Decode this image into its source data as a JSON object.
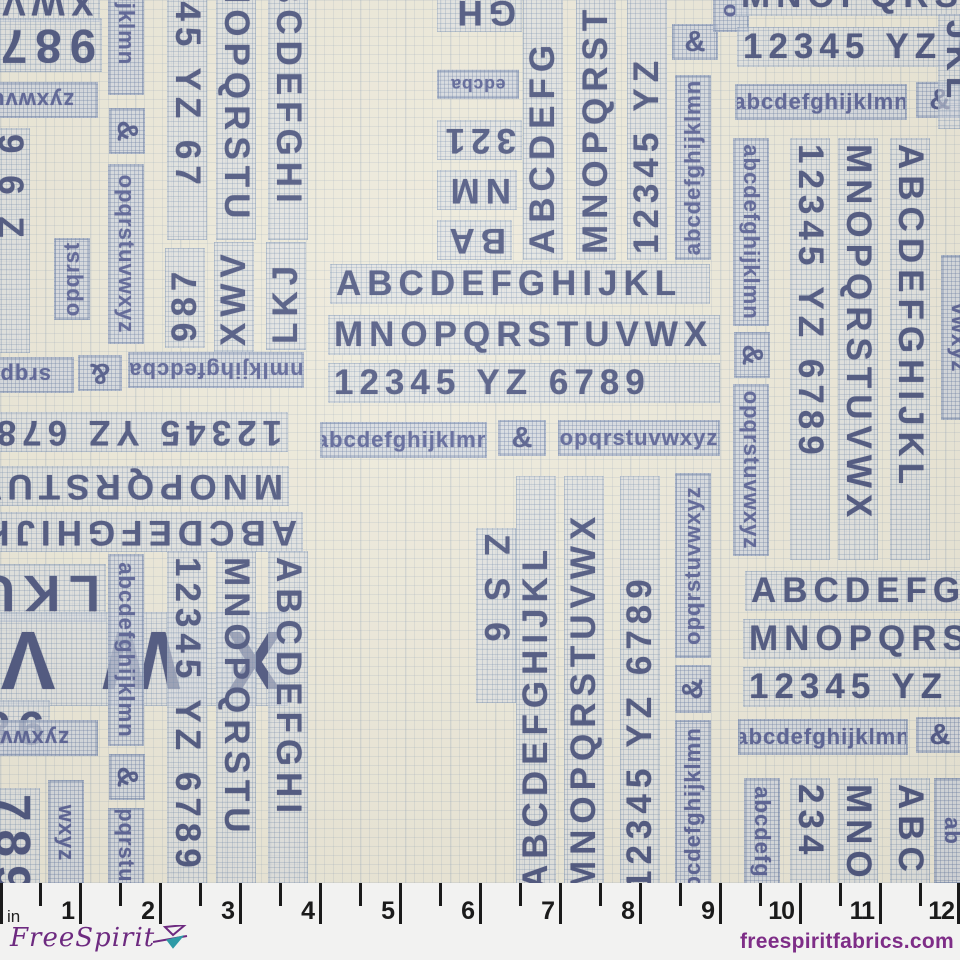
{
  "fabric": {
    "description": "typography letter-chart fabric print",
    "background_color": "#ece9db",
    "grid_color": "#7d94b2",
    "caps_color": "#3b4677",
    "lowercase_color": "#4a5490",
    "alphabet_rows": {
      "row_caps_1": "ABCDEFGHIJKL",
      "row_caps_2": "MNOPQRSTUVWX",
      "row_digits": "12345 YZ 6789",
      "row_lower_1": "abcdefghijklmn",
      "row_amp": "&",
      "row_lower_2": "opqrstuvwxyz"
    },
    "strips": [
      {
        "t": "XWV",
        "k": "caps",
        "x": -20,
        "y": -18,
        "l": 120,
        "r": 180
      },
      {
        "t": "987",
        "k": "caps",
        "x": -48,
        "y": 18,
        "l": 150,
        "r": 180,
        "s": 1.35
      },
      {
        "t": "zyxwvut",
        "k": "box",
        "x": -42,
        "y": 82,
        "l": 140,
        "r": 180
      },
      {
        "t": "9 6 Z",
        "k": "caps",
        "x": -10,
        "y": 128,
        "l": 225,
        "r": 90
      },
      {
        "t": "abcdefghijklmn",
        "k": "box",
        "x": 108,
        "y": -140,
        "l": 235,
        "r": 90
      },
      {
        "t": "&",
        "k": "amp",
        "x": 109,
        "y": 108,
        "l": 46,
        "r": 90
      },
      {
        "t": "opqrstuvwxyz",
        "k": "box",
        "x": 108,
        "y": 164,
        "l": 180,
        "r": 90
      },
      {
        "t": "345 YZ 67",
        "k": "caps",
        "x": 167,
        "y": -30,
        "l": 270,
        "r": 90
      },
      {
        "t": "NOPQRSTU",
        "k": "caps",
        "x": 216,
        "y": -28,
        "l": 268,
        "r": 90
      },
      {
        "t": "BCDEFGHI",
        "k": "caps",
        "x": 268,
        "y": -28,
        "l": 268,
        "r": 90
      },
      {
        "t": "987",
        "k": "caps",
        "x": 165,
        "y": 248,
        "l": 100,
        "r": -90
      },
      {
        "t": "XWV",
        "k": "caps",
        "x": 214,
        "y": 242,
        "l": 110,
        "r": -90
      },
      {
        "t": "LKJ",
        "k": "caps",
        "x": 266,
        "y": 242,
        "l": 108,
        "r": -90
      },
      {
        "t": "opqrst",
        "k": "box",
        "x": 54,
        "y": 238,
        "l": 82,
        "r": -90
      },
      {
        "t": "srqpo",
        "k": "box",
        "x": -38,
        "y": 357,
        "l": 112,
        "r": 180
      },
      {
        "t": "&",
        "k": "amp",
        "x": 78,
        "y": 355,
        "l": 44,
        "r": 180
      },
      {
        "t": "nmlkjihgfedcba",
        "k": "box",
        "x": 128,
        "y": 352,
        "l": 176,
        "r": 180
      },
      {
        "t": "12345 YZ 6789",
        "k": "caps",
        "x": -112,
        "y": 412,
        "l": 400,
        "r": 180
      },
      {
        "t": "MNOPQRSTUVWX",
        "k": "caps",
        "x": -96,
        "y": 466,
        "l": 385,
        "r": 180
      },
      {
        "t": "ABCDEFGHIJKL",
        "k": "caps",
        "x": -82,
        "y": 512,
        "l": 385,
        "r": 180
      },
      {
        "t": "LKU",
        "k": "caps",
        "x": -14,
        "y": 564,
        "l": 120,
        "r": 180,
        "s": 1.45
      },
      {
        "t": "XWV",
        "k": "caps",
        "x": -42,
        "y": 612,
        "l": 330,
        "r": 180,
        "s": 2.35,
        "ls": 20
      },
      {
        "t": "987",
        "k": "caps",
        "x": -110,
        "y": 700,
        "l": 160,
        "r": 180,
        "s": 1.35
      },
      {
        "t": "zyxwvu",
        "k": "box",
        "x": -44,
        "y": 720,
        "l": 142,
        "r": 180
      },
      {
        "t": "wxyz",
        "k": "box",
        "x": 48,
        "y": 780,
        "l": 106,
        "r": 90
      },
      {
        "t": "789",
        "k": "caps",
        "x": -16,
        "y": 788,
        "l": 120,
        "r": 90,
        "s": 1.4
      },
      {
        "t": "abcdefghijklmn",
        "k": "box",
        "x": 108,
        "y": 554,
        "l": 192,
        "r": 90
      },
      {
        "t": "&",
        "k": "amp",
        "x": 109,
        "y": 754,
        "l": 46,
        "r": 90
      },
      {
        "t": "opqrstuvwxyz",
        "k": "box",
        "x": 108,
        "y": 808,
        "l": 130,
        "r": 90
      },
      {
        "t": "12345 YZ 6789",
        "k": "caps",
        "x": 167,
        "y": 551,
        "l": 400,
        "r": 90
      },
      {
        "t": "MNOPQRSTU",
        "k": "caps",
        "x": 216,
        "y": 551,
        "l": 336,
        "r": 90
      },
      {
        "t": "ABCDEFGHI",
        "k": "caps",
        "x": 268,
        "y": 551,
        "l": 336,
        "r": 90
      },
      {
        "t": "GH",
        "k": "caps",
        "x": 437,
        "y": -8,
        "l": 85,
        "r": 180
      },
      {
        "t": "edcba",
        "k": "box",
        "x": 437,
        "y": 70,
        "l": 82,
        "r": 180,
        "s": 0.8
      },
      {
        "t": "321",
        "k": "caps",
        "x": 437,
        "y": 120,
        "l": 85,
        "r": 180
      },
      {
        "t": "NM",
        "k": "caps",
        "x": 437,
        "y": 170,
        "l": 80,
        "r": 180
      },
      {
        "t": "BA",
        "k": "caps",
        "x": 437,
        "y": 220,
        "l": 75,
        "r": 180
      },
      {
        "t": "ABCDEFG",
        "k": "caps",
        "x": 523,
        "y": -45,
        "l": 305,
        "r": -90
      },
      {
        "t": "MNOPQRST",
        "k": "caps",
        "x": 576,
        "y": -85,
        "l": 345,
        "r": -90
      },
      {
        "t": "12345 YZ",
        "k": "caps",
        "x": 627,
        "y": -40,
        "l": 300,
        "r": -90
      },
      {
        "t": "&",
        "k": "amp",
        "x": 672,
        "y": 24,
        "l": 46,
        "r": 0
      },
      {
        "t": "o",
        "k": "box",
        "x": 713,
        "y": -10,
        "l": 42,
        "r": 90
      },
      {
        "t": "abcdefghijklmn",
        "k": "box",
        "x": 675,
        "y": 75,
        "l": 185,
        "r": -90
      },
      {
        "t": "ABCDEFGHIJKL",
        "k": "caps",
        "x": 330,
        "y": 264,
        "l": 380,
        "r": 0
      },
      {
        "t": "MNOPQRSTUVWX",
        "k": "caps",
        "x": 328,
        "y": 315,
        "l": 392,
        "r": 0
      },
      {
        "t": "12345 YZ 6789",
        "k": "caps",
        "x": 328,
        "y": 363,
        "l": 392,
        "r": 0
      },
      {
        "t": "abcdefghijklmn",
        "k": "box",
        "x": 320,
        "y": 422,
        "l": 167,
        "r": 0
      },
      {
        "t": "&",
        "k": "amp",
        "x": 498,
        "y": 420,
        "l": 48,
        "r": 0
      },
      {
        "t": "opqrstuvwxyz",
        "k": "box",
        "x": 558,
        "y": 420,
        "l": 162,
        "r": 0
      },
      {
        "t": "MNOPQRSTUVWX",
        "k": "caps",
        "x": 735,
        "y": -24,
        "l": 392,
        "r": 0
      },
      {
        "t": "12345 YZ 6789",
        "k": "caps",
        "x": 737,
        "y": 27,
        "l": 392,
        "r": 0
      },
      {
        "t": "abcdefghijklmn",
        "k": "box",
        "x": 735,
        "y": 84,
        "l": 172,
        "r": 0
      },
      {
        "t": "&",
        "k": "amp",
        "x": 916,
        "y": 82,
        "l": 48,
        "r": 0
      },
      {
        "t": "abcdefghijklmn",
        "k": "box",
        "x": 733,
        "y": 138,
        "l": 188,
        "r": 90
      },
      {
        "t": "&",
        "k": "amp",
        "x": 734,
        "y": 332,
        "l": 46,
        "r": 90
      },
      {
        "t": "opqrstuvwxyz",
        "k": "box",
        "x": 733,
        "y": 384,
        "l": 172,
        "r": 90
      },
      {
        "t": "12345 YZ 6789",
        "k": "caps",
        "x": 790,
        "y": 138,
        "l": 422,
        "r": 90
      },
      {
        "t": "MNOPQRSTUVWX",
        "k": "caps",
        "x": 838,
        "y": 138,
        "l": 422,
        "r": 90
      },
      {
        "t": "ABCDEFGHIJKL",
        "k": "caps",
        "x": 890,
        "y": 138,
        "l": 422,
        "r": 90
      },
      {
        "t": "vwxyz",
        "k": "box",
        "x": 941,
        "y": 255,
        "l": 165,
        "r": 90
      },
      {
        "t": "JKL",
        "k": "caps",
        "x": 938,
        "y": 14,
        "l": 115,
        "r": 90
      },
      {
        "t": "Z S 6",
        "k": "caps",
        "x": 476,
        "y": 528,
        "l": 175,
        "r": 90
      },
      {
        "t": "ABCDEFGHIJKL",
        "k": "caps",
        "x": 516,
        "y": 476,
        "l": 420,
        "r": -90
      },
      {
        "t": "MNOPQRSTUVWX",
        "k": "caps",
        "x": 564,
        "y": 476,
        "l": 420,
        "r": -90
      },
      {
        "t": "12345 YZ 6789",
        "k": "caps",
        "x": 620,
        "y": 476,
        "l": 420,
        "r": -90
      },
      {
        "t": "opqrstuvwxyz",
        "k": "box",
        "x": 675,
        "y": 473,
        "l": 185,
        "r": -90
      },
      {
        "t": "&",
        "k": "amp",
        "x": 675,
        "y": 665,
        "l": 48,
        "r": -90
      },
      {
        "t": "abcdefghijklmn",
        "k": "box",
        "x": 675,
        "y": 720,
        "l": 190,
        "r": -90
      },
      {
        "t": "ABCDEFGH",
        "k": "caps",
        "x": 745,
        "y": 571,
        "l": 300,
        "r": 0
      },
      {
        "t": "MNOPQRSTU",
        "k": "caps",
        "x": 743,
        "y": 619,
        "l": 300,
        "r": 0
      },
      {
        "t": "12345 YZ",
        "k": "caps",
        "x": 743,
        "y": 667,
        "l": 300,
        "r": 0
      },
      {
        "t": "abcdefghijklmn",
        "k": "box",
        "x": 738,
        "y": 719,
        "l": 170,
        "r": 0
      },
      {
        "t": "&",
        "k": "amp",
        "x": 916,
        "y": 717,
        "l": 48,
        "r": 0
      },
      {
        "t": "abcdefg",
        "k": "box",
        "x": 744,
        "y": 778,
        "l": 108,
        "r": 90
      },
      {
        "t": "234",
        "k": "caps",
        "x": 790,
        "y": 778,
        "l": 110,
        "r": 90
      },
      {
        "t": "MNO",
        "k": "caps",
        "x": 838,
        "y": 778,
        "l": 110,
        "r": 90
      },
      {
        "t": "ABC",
        "k": "caps",
        "x": 890,
        "y": 778,
        "l": 110,
        "r": 90
      },
      {
        "t": "ab",
        "k": "box",
        "x": 934,
        "y": 778,
        "l": 106,
        "r": 90
      }
    ]
  },
  "ruler": {
    "unit_label": "in",
    "inch_px": 80,
    "numbers": [
      "1",
      "2",
      "3",
      "4",
      "5",
      "6",
      "7",
      "8",
      "9",
      "10",
      "11",
      "12"
    ],
    "tick_color": "#1b1b1b",
    "background_color": "#f2f2f1"
  },
  "branding": {
    "logo_text": "FreeSpirit",
    "website": "freespiritfabrics.com",
    "logo_color": "#6d2a80",
    "accent_teal": "#2e9aa6"
  }
}
